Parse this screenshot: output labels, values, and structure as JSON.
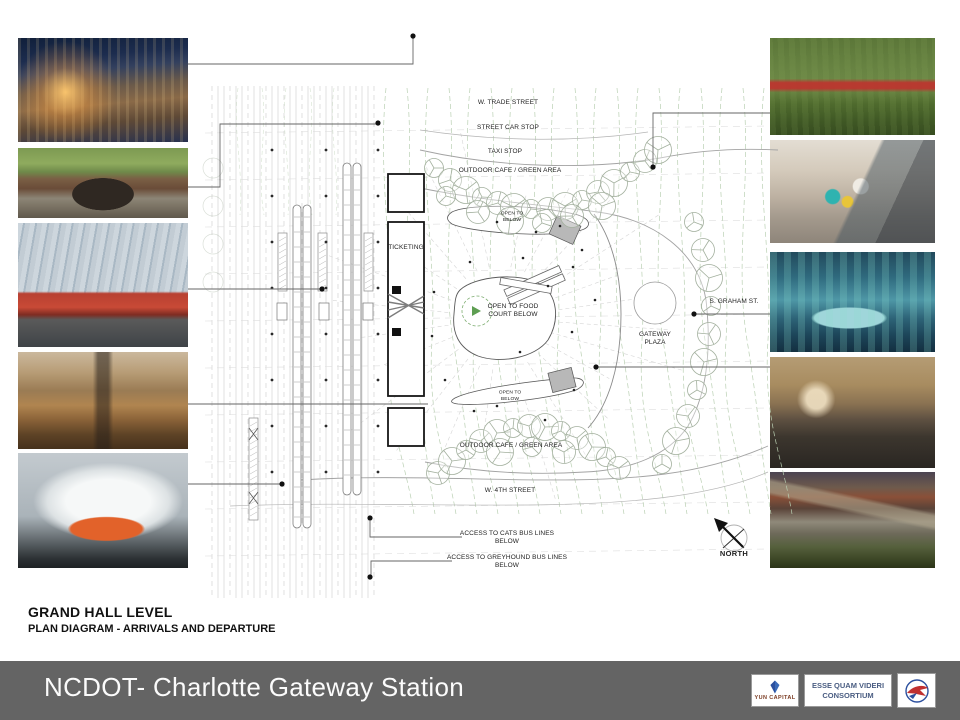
{
  "plan": {
    "labels": [
      {
        "id": "w-trade-street",
        "text": "W. TRADE STREET"
      },
      {
        "id": "street-car-stop",
        "text": "STREET CAR STOP"
      },
      {
        "id": "taxi-stop",
        "text": "TAXI STOP"
      },
      {
        "id": "outdoor-cafe-top",
        "text": "OUTDOOR CAFE / GREEN AREA"
      },
      {
        "id": "open-to-below-top",
        "text": "OPEN TO\nBELOW"
      },
      {
        "id": "ticketing",
        "text": "TICKETING"
      },
      {
        "id": "open-to-food-court",
        "text": "OPEN TO FOOD\nCOURT BELOW"
      },
      {
        "id": "gateway-plaza",
        "text": "GATEWAY\nPLAZA"
      },
      {
        "id": "s-graham-st",
        "text": "S. GRAHAM ST."
      },
      {
        "id": "open-to-below-bottom",
        "text": "OPEN TO\nBELOW"
      },
      {
        "id": "outdoor-cafe-bottom",
        "text": "OUTDOOR CAFE / GREEN AREA"
      },
      {
        "id": "w-4th-street",
        "text": "W. 4TH STREET"
      },
      {
        "id": "access-cats",
        "text": "ACCESS TO CATS BUS LINES\nBELOW"
      },
      {
        "id": "access-greyhound",
        "text": "ACCESS TO GREYHOUND BUS LINES\nBELOW"
      },
      {
        "id": "north",
        "text": "NORTH"
      }
    ]
  },
  "titles": {
    "heading": "GRAND HALL LEVEL",
    "subheading": "PLAN DIAGRAM - ARRIVALS AND DEPARTURE"
  },
  "footer": {
    "project_title": "NCDOT- Charlotte Gateway Station",
    "logos": {
      "yun_capital": {
        "label": "YUN CAPITAL"
      },
      "consortium": {
        "line1": "ESSE QUAM VIDERI",
        "line2": "CONSORTIUM"
      }
    }
  },
  "photos": {
    "left": [
      {
        "name": "night-plaza-building"
      },
      {
        "name": "brick-station-arch"
      },
      {
        "name": "glass-trainshed-red-train"
      },
      {
        "name": "station-concourse-interior"
      },
      {
        "name": "highspeed-train"
      }
    ],
    "right": [
      {
        "name": "urban-park-cafe"
      },
      {
        "name": "family-escalator"
      },
      {
        "name": "atrium-fountain-plaza"
      },
      {
        "name": "grand-hall-crowd"
      },
      {
        "name": "elevated-park-dusk"
      }
    ]
  },
  "colors": {
    "footer_bar": "#646464",
    "consortium_text": "#4a5d82",
    "tree_outline": "#a3b09e",
    "contour_green": "#bad0b3"
  }
}
